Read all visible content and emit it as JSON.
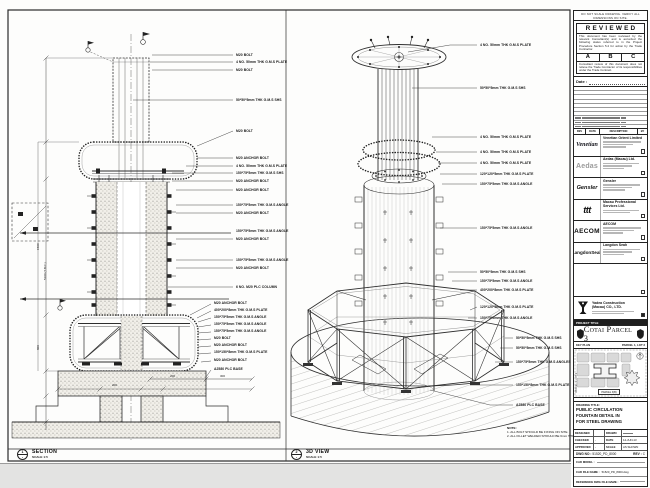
{
  "section_view": {
    "title": "SECTION",
    "scale": "SCALE 1:5",
    "bubble": {
      "number": "1",
      "sheet": "-"
    },
    "callouts": [
      "M20 BOLT",
      "4 NO. 50mm THK G.M.S PLATE",
      "M20 BOLT",
      "50*50*5mm THK G.M.S SHS",
      "M20 BOLT",
      "M20 ANCHOR BOLT",
      "4 NO. 50mm THK G.M.S PLATE",
      "150*75*5mm THK G.M.S SHS",
      "M20 ANCHOR BOLT",
      "M20 ANCHOR BOLT",
      "150*75*5mm THK G.M.S ANGLE",
      "M20 ANCHOR BOLT",
      "150*75*5mm THK G.M.S ANGLE",
      "M20 ANCHOR BOLT",
      "150*75*5mm THK G.M.S ANGLE",
      "M20 ANCHOR BOLT",
      "6 NO. M20 PLC COLUMN",
      "M20 ANCHOR BOLT",
      "400*200*8mm THK G.M.S PLATE",
      "150*75*5mm THK G.M.S ANGLE",
      "150*75*5mm THK G.M.S ANGLE",
      "150*75*5mm THK G.M.S ANGLE",
      "M20 BOLT",
      "M20 ANCHOR BOLT",
      "150*150*8mm THK G.M.S PLATE",
      "M20 ANCHOR BOLT",
      "A2580 PLC BASE"
    ],
    "dims": {
      "left1": "5100 (T.B.C.)",
      "left2": "1500",
      "left3": "800",
      "bottom": [
        "200",
        "300",
        "200"
      ]
    }
  },
  "iso_view": {
    "title": "3D VIEW",
    "scale": "SCALE 1:5",
    "bubble": {
      "number": "2",
      "sheet": "-"
    },
    "callouts": [
      "4 NO. 50mm THK G.M.S PLATE",
      "50*50*5mm THK G.M.S SHS",
      "4 NO. 50mm THK G.M.S PLATE",
      "4 NO. 50mm THK G.M.S PLATE",
      "4 NO. 50mm THK G.M.S PLATE",
      "120*120*5mm THK G.M.S PLATE",
      "150*75*5mm THK G.M.S ANGLE",
      "150*75*5mm THK G.M.S ANGLE",
      "50*50*5mm THK G.M.S SHS",
      "150*75*5mm THK G.M.S ANGLE",
      "400*200*8mm THK G.M.S PLATE",
      "120*120*5mm THK G.M.S PLATE",
      "150*75*5mm THK G.M.S ANGLE",
      "50*50*5mm THK G.M.S SHS",
      "50*50*5mm THK G.M.S SHS",
      "150*75*5mm THK G.M.S ANGLES",
      "150*150*8mm THK G.M.S PLATE",
      "A2580 PLC BASE"
    ],
    "note_title": "NOTE:",
    "notes": [
      "1. ALL BOLT SHOULD BE FIXING ON SITE.",
      "2. ALL FILLET WELDED SHOULD BE 6mm THK."
    ]
  },
  "title_block": {
    "edge_note": "DO NOT SCALE DRAWING. VERIFY ALL DIMENSIONS ON SITE.",
    "reviewed": {
      "title": "REVIEWED",
      "body1": "This document has been reviewed by the relevant Consultant(s) and is accorded the following status referred to in the Project Procedure Section 5.4 for action by the Trade Contractor.",
      "options": [
        "A",
        "B",
        "C"
      ],
      "body2": "Consultant review of this document does not relieve the Trade Contractor of its responsibilities under the Trade Contract.",
      "date_label": "Date :"
    },
    "revision_header": {
      "rev": "REV",
      "date": "DATE",
      "description": "DESCRIPTION",
      "by": "BY"
    },
    "companies": [
      {
        "logo_text": "Venetian",
        "name": "Venetian Orient Limited"
      },
      {
        "logo_text": "Aedas",
        "name": "Aedas (Macau) Ltd."
      },
      {
        "logo_text": "Gensler",
        "name": "Gensler"
      },
      {
        "logo_text": "ttt",
        "name": "Macau Professional Services Ltd."
      },
      {
        "logo_text": "AECOM",
        "name": "AECOM"
      },
      {
        "logo_text": "LangdonSeah",
        "name": "Langdon Seah"
      }
    ],
    "contractor": {
      "name_line1": "Yadea Construction",
      "name_line2": "(Macau) CO., LTD."
    },
    "project": {
      "label": "PROJECT TITLE",
      "title": "Cotai Parcel 3"
    },
    "key_plan": {
      "label": "KEY PLAN",
      "sublabel": "PARCEL 1, LOT 3",
      "side_label": "PARCEL 1, LOT 2",
      "tag": "PARCEL 3(B)"
    },
    "drawing_title": {
      "label": "DRAWING TITLE:",
      "line1": "PUBLIC CIRCULATION",
      "line2": "FOUNTAIN DETAIL IN",
      "line3": "FOR STEEL DRAWING"
    },
    "info": {
      "designed_label": "DESIGNED",
      "checked_label": "CHECKED",
      "approved_label": "APPROVED",
      "drawn_label": "DRAWN",
      "date_label": "DATE",
      "scale_label": "SCALE",
      "checked_value": "-",
      "approved_value": "-",
      "date_value": "14-JUN-13",
      "scale_value": "AS SHOWN"
    },
    "dwg": {
      "label": "DWG NO :",
      "value": "51520_PD_8000",
      "rev_label": "REV :",
      "rev_value": "C"
    },
    "cad": {
      "model_label": "CAD MODEL :",
      "file_label": "CAD FILE NAME :",
      "file_value": "51520_PD_8000.dwg",
      "ref_label": "REFERENCE DWG FILE NAME :"
    }
  }
}
